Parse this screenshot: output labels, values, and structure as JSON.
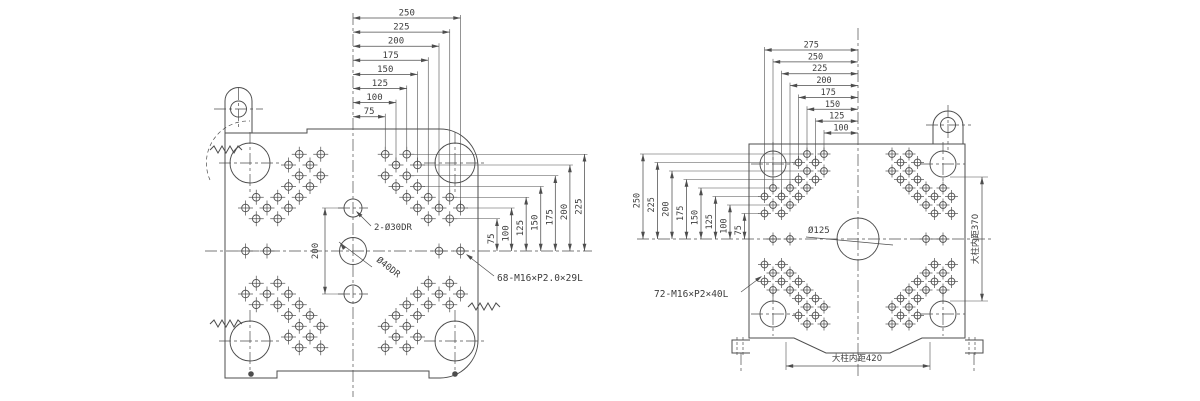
{
  "colors": {
    "line": "#4d4d4d",
    "text": "#3d3d3d",
    "bg": "#ffffff"
  },
  "left_view": {
    "top_dims": [
      "250",
      "225",
      "200",
      "175",
      "150",
      "125",
      "100",
      "75"
    ],
    "side_dims": [
      "75",
      "100",
      "125",
      "150",
      "175",
      "200",
      "225"
    ],
    "vertical_dim": "200",
    "pilot_hole_label": "2-Ø30DR",
    "center_hole_label": "Ø40DR",
    "bolt_label": "68-M16×P2.0×29L"
  },
  "right_view": {
    "top_dims": [
      "275",
      "250",
      "225",
      "200",
      "175",
      "150",
      "125",
      "100"
    ],
    "side_dims": [
      "250",
      "225",
      "200",
      "175",
      "150",
      "125",
      "100",
      "75"
    ],
    "center_hole_label": "Ø125",
    "bolt_label": "72-M16×P2×40L",
    "tie_bar_width_label": "大柱内距420",
    "tie_bar_height_label": "大柱内距370"
  }
}
